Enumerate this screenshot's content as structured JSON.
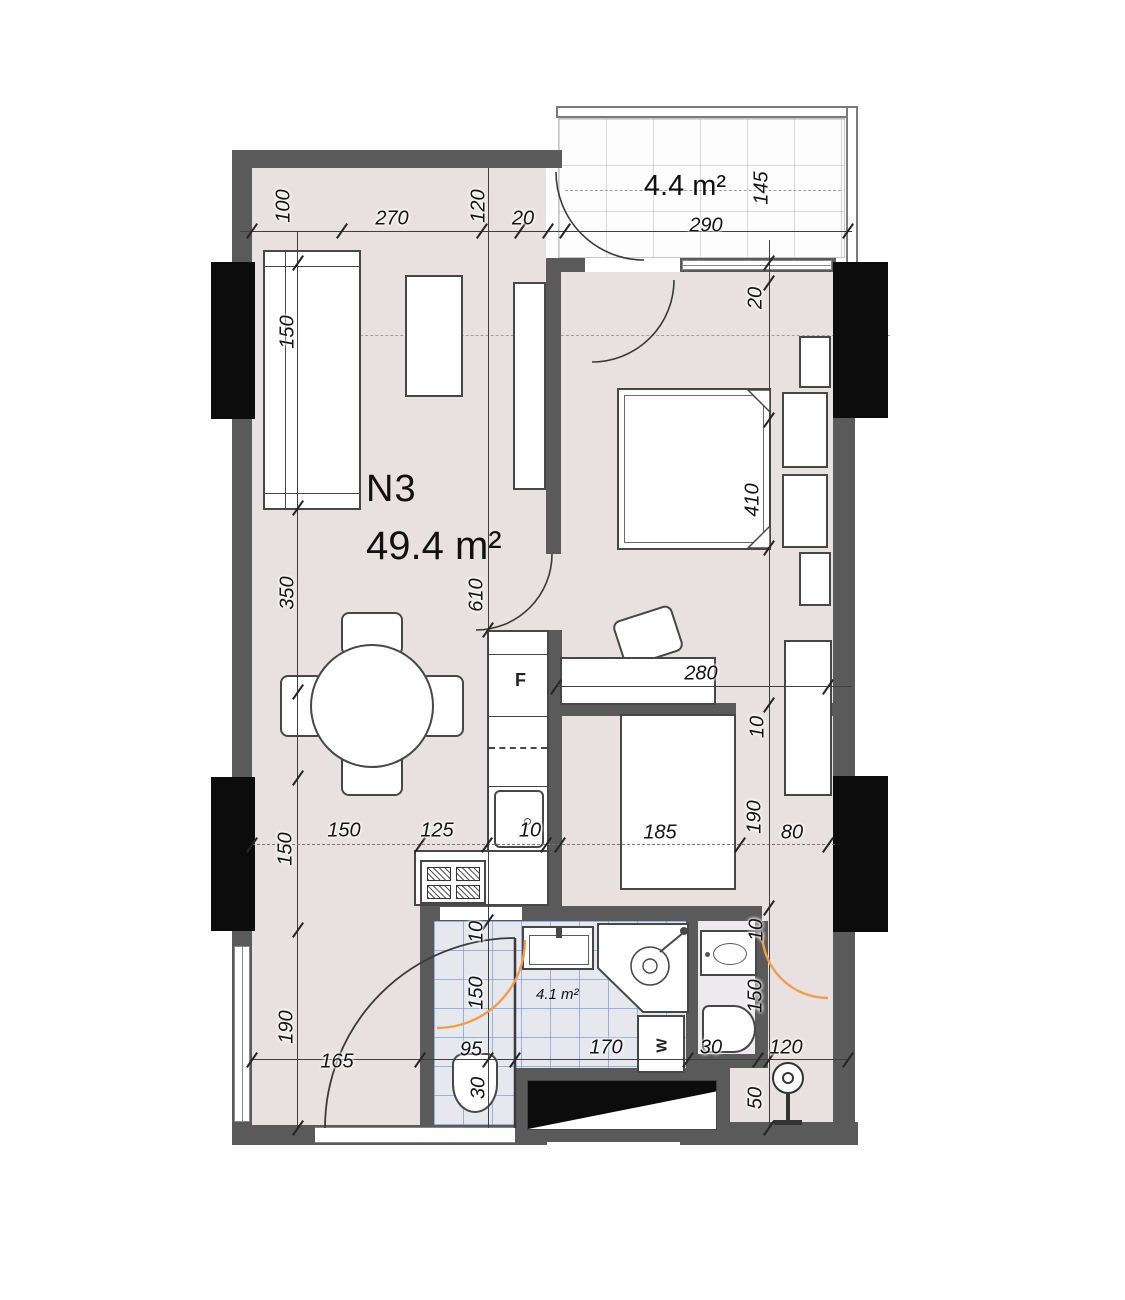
{
  "plan": {
    "unit_label": "N3",
    "unit_area": "49.4 m²",
    "balcony_area": "4.4 m²",
    "bathroom_area": "4.1 m²"
  },
  "appliances": {
    "fridge_label": "F",
    "washer_label": "W"
  },
  "colors": {
    "wall": "#5A5A5A",
    "column": "#0C0C0C",
    "floor": "#E9E1E1",
    "bath_tile_line": "#7D9EDA",
    "door_swing_accent": "#F09E4E"
  },
  "dimensions_cm": [
    {
      "text": "100",
      "x": 284,
      "y": 206,
      "rot": 1
    },
    {
      "text": "270",
      "x": 392,
      "y": 219
    },
    {
      "text": "120",
      "x": 479,
      "y": 206,
      "rot": 1
    },
    {
      "text": "20",
      "x": 523,
      "y": 219
    },
    {
      "text": "290",
      "x": 706,
      "y": 226
    },
    {
      "text": "145",
      "x": 762,
      "y": 188,
      "rot": 1
    },
    {
      "text": "20",
      "x": 756,
      "y": 298,
      "rot": 1
    },
    {
      "text": "410",
      "x": 753,
      "y": 500,
      "rot": 1
    },
    {
      "text": "10",
      "x": 758,
      "y": 727,
      "rot": 1
    },
    {
      "text": "190",
      "x": 755,
      "y": 817,
      "rot": 1
    },
    {
      "text": "10",
      "x": 757,
      "y": 930,
      "rot": 1
    },
    {
      "text": "150",
      "x": 756,
      "y": 996,
      "rot": 1
    },
    {
      "text": "50",
      "x": 756,
      "y": 1098,
      "rot": 1
    },
    {
      "text": "150",
      "x": 288,
      "y": 332,
      "rot": 1
    },
    {
      "text": "350",
      "x": 288,
      "y": 593,
      "rot": 1
    },
    {
      "text": "150",
      "x": 286,
      "y": 849,
      "rot": 1
    },
    {
      "text": "190",
      "x": 287,
      "y": 1027,
      "rot": 1
    },
    {
      "text": "610",
      "x": 477,
      "y": 595,
      "rot": 1
    },
    {
      "text": "280",
      "x": 701,
      "y": 674
    },
    {
      "text": "150",
      "x": 344,
      "y": 831
    },
    {
      "text": "125",
      "x": 437,
      "y": 831
    },
    {
      "text": "10",
      "x": 530,
      "y": 831
    },
    {
      "text": "185",
      "x": 660,
      "y": 833
    },
    {
      "text": "80",
      "x": 792,
      "y": 833
    },
    {
      "text": "10",
      "x": 477,
      "y": 932,
      "rot": 1
    },
    {
      "text": "150",
      "x": 477,
      "y": 993,
      "rot": 1
    },
    {
      "text": "95",
      "x": 471,
      "y": 1050
    },
    {
      "text": "30",
      "x": 479,
      "y": 1088,
      "rot": 1
    },
    {
      "text": "170",
      "x": 606,
      "y": 1048
    },
    {
      "text": "30",
      "x": 711,
      "y": 1048
    },
    {
      "text": "120",
      "x": 786,
      "y": 1048
    },
    {
      "text": "165",
      "x": 337,
      "y": 1062
    }
  ]
}
